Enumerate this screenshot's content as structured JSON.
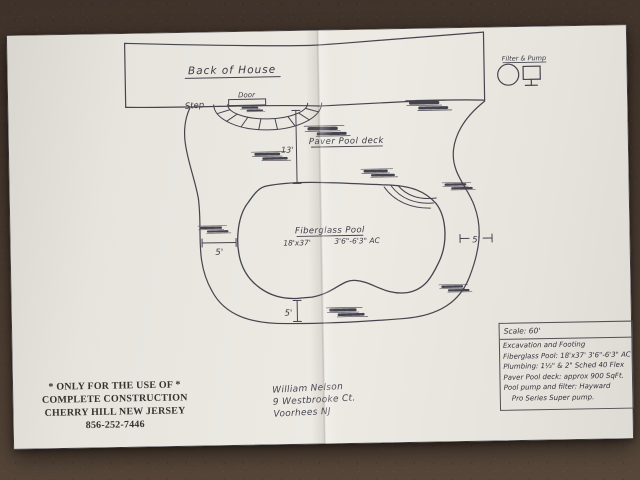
{
  "colors": {
    "paper": "#eae7e1",
    "carpet": "#4a3b30",
    "ink": "#45444e",
    "grid": "#c9c7c1"
  },
  "drawing": {
    "house_label": "Back of House",
    "door_label": "Door",
    "step_label": "Step",
    "deck_label": "Paver Pool deck",
    "deck_width_dim": "13'",
    "pool_label": "Fiberglass Pool",
    "pool_dims": "18'x37'",
    "pool_depth": "3'6\"-6'3\" AC",
    "dim_left": "5'",
    "dim_right": "5'",
    "dim_bottom": "5'",
    "equipment_label": "Filter & Pump"
  },
  "spec_box": {
    "scale": "Scale: 60'",
    "lines": [
      "Excavation and Footing",
      "Fiberglass Pool: 18'x37'  3'6\"-6'3\" AC",
      "Plumbing: 1½\" & 2\" Sched 40 Flex",
      "Paver Pool deck: approx 900 SqFt.",
      "Pool pump and filter: Hayward",
      "Pro Series Super pump."
    ]
  },
  "contractor": {
    "line1": "* ONLY FOR THE USE OF *",
    "line2": "COMPLETE CONSTRUCTION",
    "line3": "CHERRY HILL NEW JERSEY",
    "phone": "856-252-7446"
  },
  "client": {
    "name": "William Nelson",
    "street": "9 Westbrooke Ct.",
    "city": "Voorhees NJ"
  }
}
